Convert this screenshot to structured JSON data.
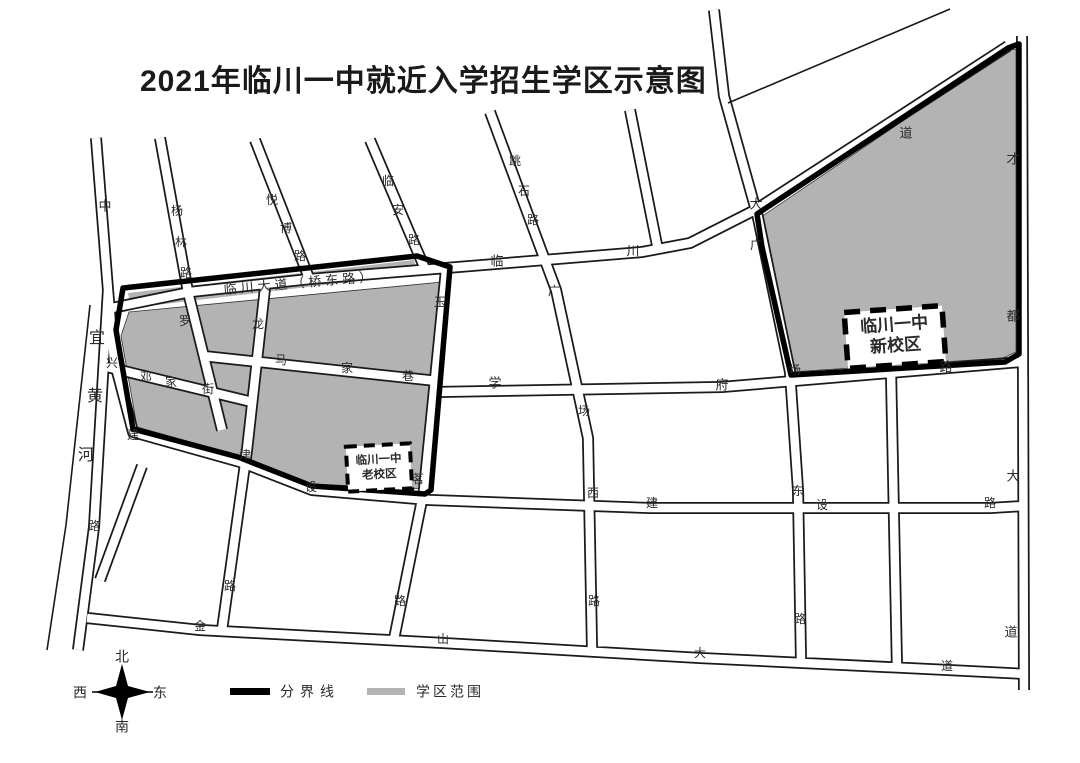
{
  "title": "2021年临川一中就近入学招生学区示意图",
  "legend": {
    "boundary_label": "分界线",
    "district_label": "学区范围",
    "boundary_color": "#000000",
    "district_color": "#b3b3b3"
  },
  "compass": {
    "north": "北",
    "south": "南",
    "east": "东",
    "west": "西"
  },
  "campuses": {
    "new": {
      "name_line1": "临川一中",
      "name_line2": "新校区"
    },
    "old": {
      "name_line1": "临川一中",
      "name_line2": "老校区"
    }
  },
  "river_name": "宜黄河",
  "map_labels": [
    {
      "t": "中",
      "x": 105,
      "y": 207,
      "s": 13
    },
    {
      "t": "杨",
      "x": 177,
      "y": 212,
      "s": 12
    },
    {
      "t": "林",
      "x": 181,
      "y": 243,
      "s": 12
    },
    {
      "t": "路",
      "x": 186,
      "y": 274,
      "s": 12
    },
    {
      "t": "悦",
      "x": 272,
      "y": 201,
      "s": 12
    },
    {
      "t": "博",
      "x": 286,
      "y": 229,
      "s": 12
    },
    {
      "t": "路",
      "x": 300,
      "y": 257,
      "s": 12
    },
    {
      "t": "临",
      "x": 388,
      "y": 182,
      "s": 12
    },
    {
      "t": "安",
      "x": 398,
      "y": 211,
      "s": 12
    },
    {
      "t": "路",
      "x": 414,
      "y": 241,
      "s": 12
    },
    {
      "t": "跳",
      "x": 515,
      "y": 162,
      "s": 12
    },
    {
      "t": "石",
      "x": 524,
      "y": 192,
      "s": 12
    },
    {
      "t": "路",
      "x": 533,
      "y": 221,
      "s": 12
    },
    {
      "t": "临川大道（桥东路）",
      "x": 300,
      "y": 284,
      "s": 13,
      "r": -5,
      "ls": 4
    },
    {
      "t": "临",
      "x": 497,
      "y": 262,
      "s": 13
    },
    {
      "t": "川",
      "x": 633,
      "y": 252,
      "s": 13
    },
    {
      "t": "大",
      "x": 756,
      "y": 205,
      "s": 13
    },
    {
      "t": "道",
      "x": 906,
      "y": 134,
      "s": 13
    },
    {
      "t": "才",
      "x": 1013,
      "y": 160,
      "s": 13
    },
    {
      "t": "都",
      "x": 1013,
      "y": 317,
      "s": 13
    },
    {
      "t": "大",
      "x": 1013,
      "y": 477,
      "s": 13
    },
    {
      "t": "道",
      "x": 1011,
      "y": 633,
      "s": 13
    },
    {
      "t": "宜",
      "x": 97,
      "y": 339,
      "s": 16
    },
    {
      "t": "黄",
      "x": 95,
      "y": 397,
      "s": 16
    },
    {
      "t": "河",
      "x": 86,
      "y": 456,
      "s": 16
    },
    {
      "t": "路",
      "x": 94,
      "y": 527,
      "s": 12
    },
    {
      "t": "兴",
      "x": 112,
      "y": 364,
      "s": 12
    },
    {
      "t": "罗",
      "x": 185,
      "y": 322,
      "s": 12
    },
    {
      "t": "邓",
      "x": 146,
      "y": 378,
      "s": 12
    },
    {
      "t": "家",
      "x": 171,
      "y": 383,
      "s": 12
    },
    {
      "t": "街",
      "x": 208,
      "y": 390,
      "s": 12
    },
    {
      "t": "龙",
      "x": 258,
      "y": 325,
      "s": 12
    },
    {
      "t": "津",
      "x": 245,
      "y": 456,
      "s": 12
    },
    {
      "t": "路",
      "x": 230,
      "y": 587,
      "s": 12
    },
    {
      "t": "马",
      "x": 281,
      "y": 361,
      "s": 12
    },
    {
      "t": "家",
      "x": 347,
      "y": 369,
      "s": 12
    },
    {
      "t": "巷",
      "x": 408,
      "y": 377,
      "s": 12
    },
    {
      "t": "玉",
      "x": 440,
      "y": 303,
      "s": 12
    },
    {
      "t": "茗",
      "x": 418,
      "y": 480,
      "s": 12
    },
    {
      "t": "路",
      "x": 400,
      "y": 602,
      "s": 12
    },
    {
      "t": "建",
      "x": 133,
      "y": 436,
      "s": 12
    },
    {
      "t": "设",
      "x": 311,
      "y": 488,
      "s": 12
    },
    {
      "t": "学",
      "x": 495,
      "y": 384,
      "s": 13
    },
    {
      "t": "府",
      "x": 722,
      "y": 386,
      "s": 13
    },
    {
      "t": "路",
      "x": 946,
      "y": 368,
      "s": 13
    },
    {
      "t": "广",
      "x": 554,
      "y": 292,
      "s": 12
    },
    {
      "t": "场",
      "x": 584,
      "y": 412,
      "s": 12
    },
    {
      "t": "西",
      "x": 593,
      "y": 494,
      "s": 12
    },
    {
      "t": "路",
      "x": 594,
      "y": 602,
      "s": 12
    },
    {
      "t": "广",
      "x": 756,
      "y": 246,
      "s": 12
    },
    {
      "t": "场",
      "x": 795,
      "y": 371,
      "s": 12
    },
    {
      "t": "东",
      "x": 798,
      "y": 492,
      "s": 12
    },
    {
      "t": "路",
      "x": 800,
      "y": 620,
      "s": 12
    },
    {
      "t": "建",
      "x": 652,
      "y": 504,
      "s": 12
    },
    {
      "t": "设",
      "x": 822,
      "y": 506,
      "s": 12
    },
    {
      "t": "路",
      "x": 990,
      "y": 504,
      "s": 12
    },
    {
      "t": "金",
      "x": 200,
      "y": 627,
      "s": 12
    },
    {
      "t": "山",
      "x": 443,
      "y": 640,
      "s": 12
    },
    {
      "t": "大",
      "x": 700,
      "y": 654,
      "s": 12
    },
    {
      "t": "道",
      "x": 947,
      "y": 667,
      "s": 12
    }
  ]
}
